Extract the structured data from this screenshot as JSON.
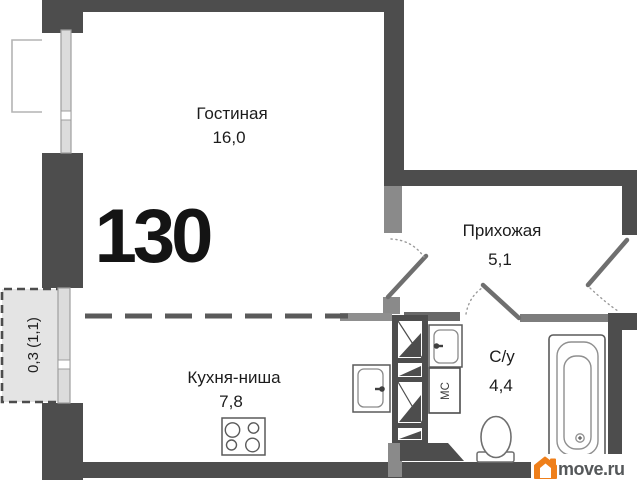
{
  "floor_plan": {
    "apartment_number": "130",
    "rooms": [
      {
        "name": "Гостиная",
        "area": "16,0"
      },
      {
        "name": "Прихожая",
        "area": "5,1"
      },
      {
        "name": "Кухня-ниша",
        "area": "7,8"
      },
      {
        "name": "С/у",
        "area": "4,4"
      }
    ],
    "balcony_label": "0,3 (1,1)",
    "washing_machine_label": "МС"
  },
  "watermark": {
    "brand": "move.ru"
  },
  "colors": {
    "wall": "#4d4d4d",
    "partition": "#6e6e6e",
    "jamb": "#8a8a8a",
    "window_fill": "#dcdcdc",
    "balcony_fill": "#e4e4e4",
    "fixture_stroke": "#5a5a5a",
    "logo_orange": "#ef7f1a",
    "logo_text": "#55585a"
  }
}
